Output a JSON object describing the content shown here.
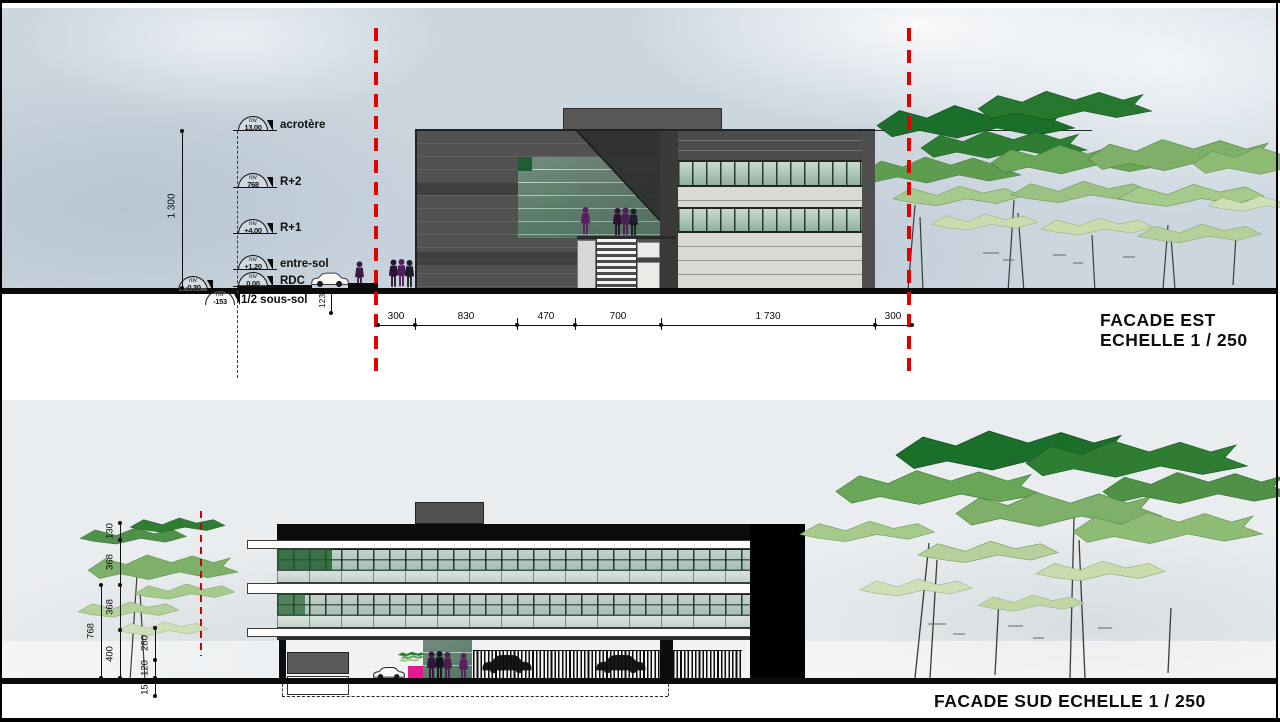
{
  "meta": {
    "niv_label": "niv",
    "scale": "1 / 250"
  },
  "facade_est": {
    "title_line1": "FACADE  EST",
    "title_line2": "ECHELLE  1 / 250",
    "levels": [
      {
        "value": "13,00",
        "label": "acrotère"
      },
      {
        "value": "768",
        "label": "R+2"
      },
      {
        "value": "+4,00",
        "label": "R+1"
      },
      {
        "value": "+1,20",
        "label": "entre-sol"
      },
      {
        "value": "0,00",
        "label": "RDC"
      },
      {
        "value": "-0,30",
        "label": ""
      },
      {
        "value": "-153",
        "label": "1/2 sous-sol"
      }
    ],
    "height_dim": "1 300",
    "step_dim": "123",
    "width_dims": [
      "300",
      "830",
      "470",
      "700",
      "1 730",
      "300"
    ]
  },
  "facade_sud": {
    "title": "FACADE  SUD  ECHELLE  1 / 250",
    "outer_dim": "768",
    "level_dims": [
      "130",
      "368",
      "368",
      "400"
    ],
    "small_dims": [
      "280",
      "120",
      "153"
    ]
  },
  "palette": {
    "axis_red": "#e00000",
    "glass_green": "#a9c4b5",
    "tree_dark": "#1c6e2b",
    "tree_light": "#cfe0b8",
    "planter_pink": "#e5188e"
  }
}
